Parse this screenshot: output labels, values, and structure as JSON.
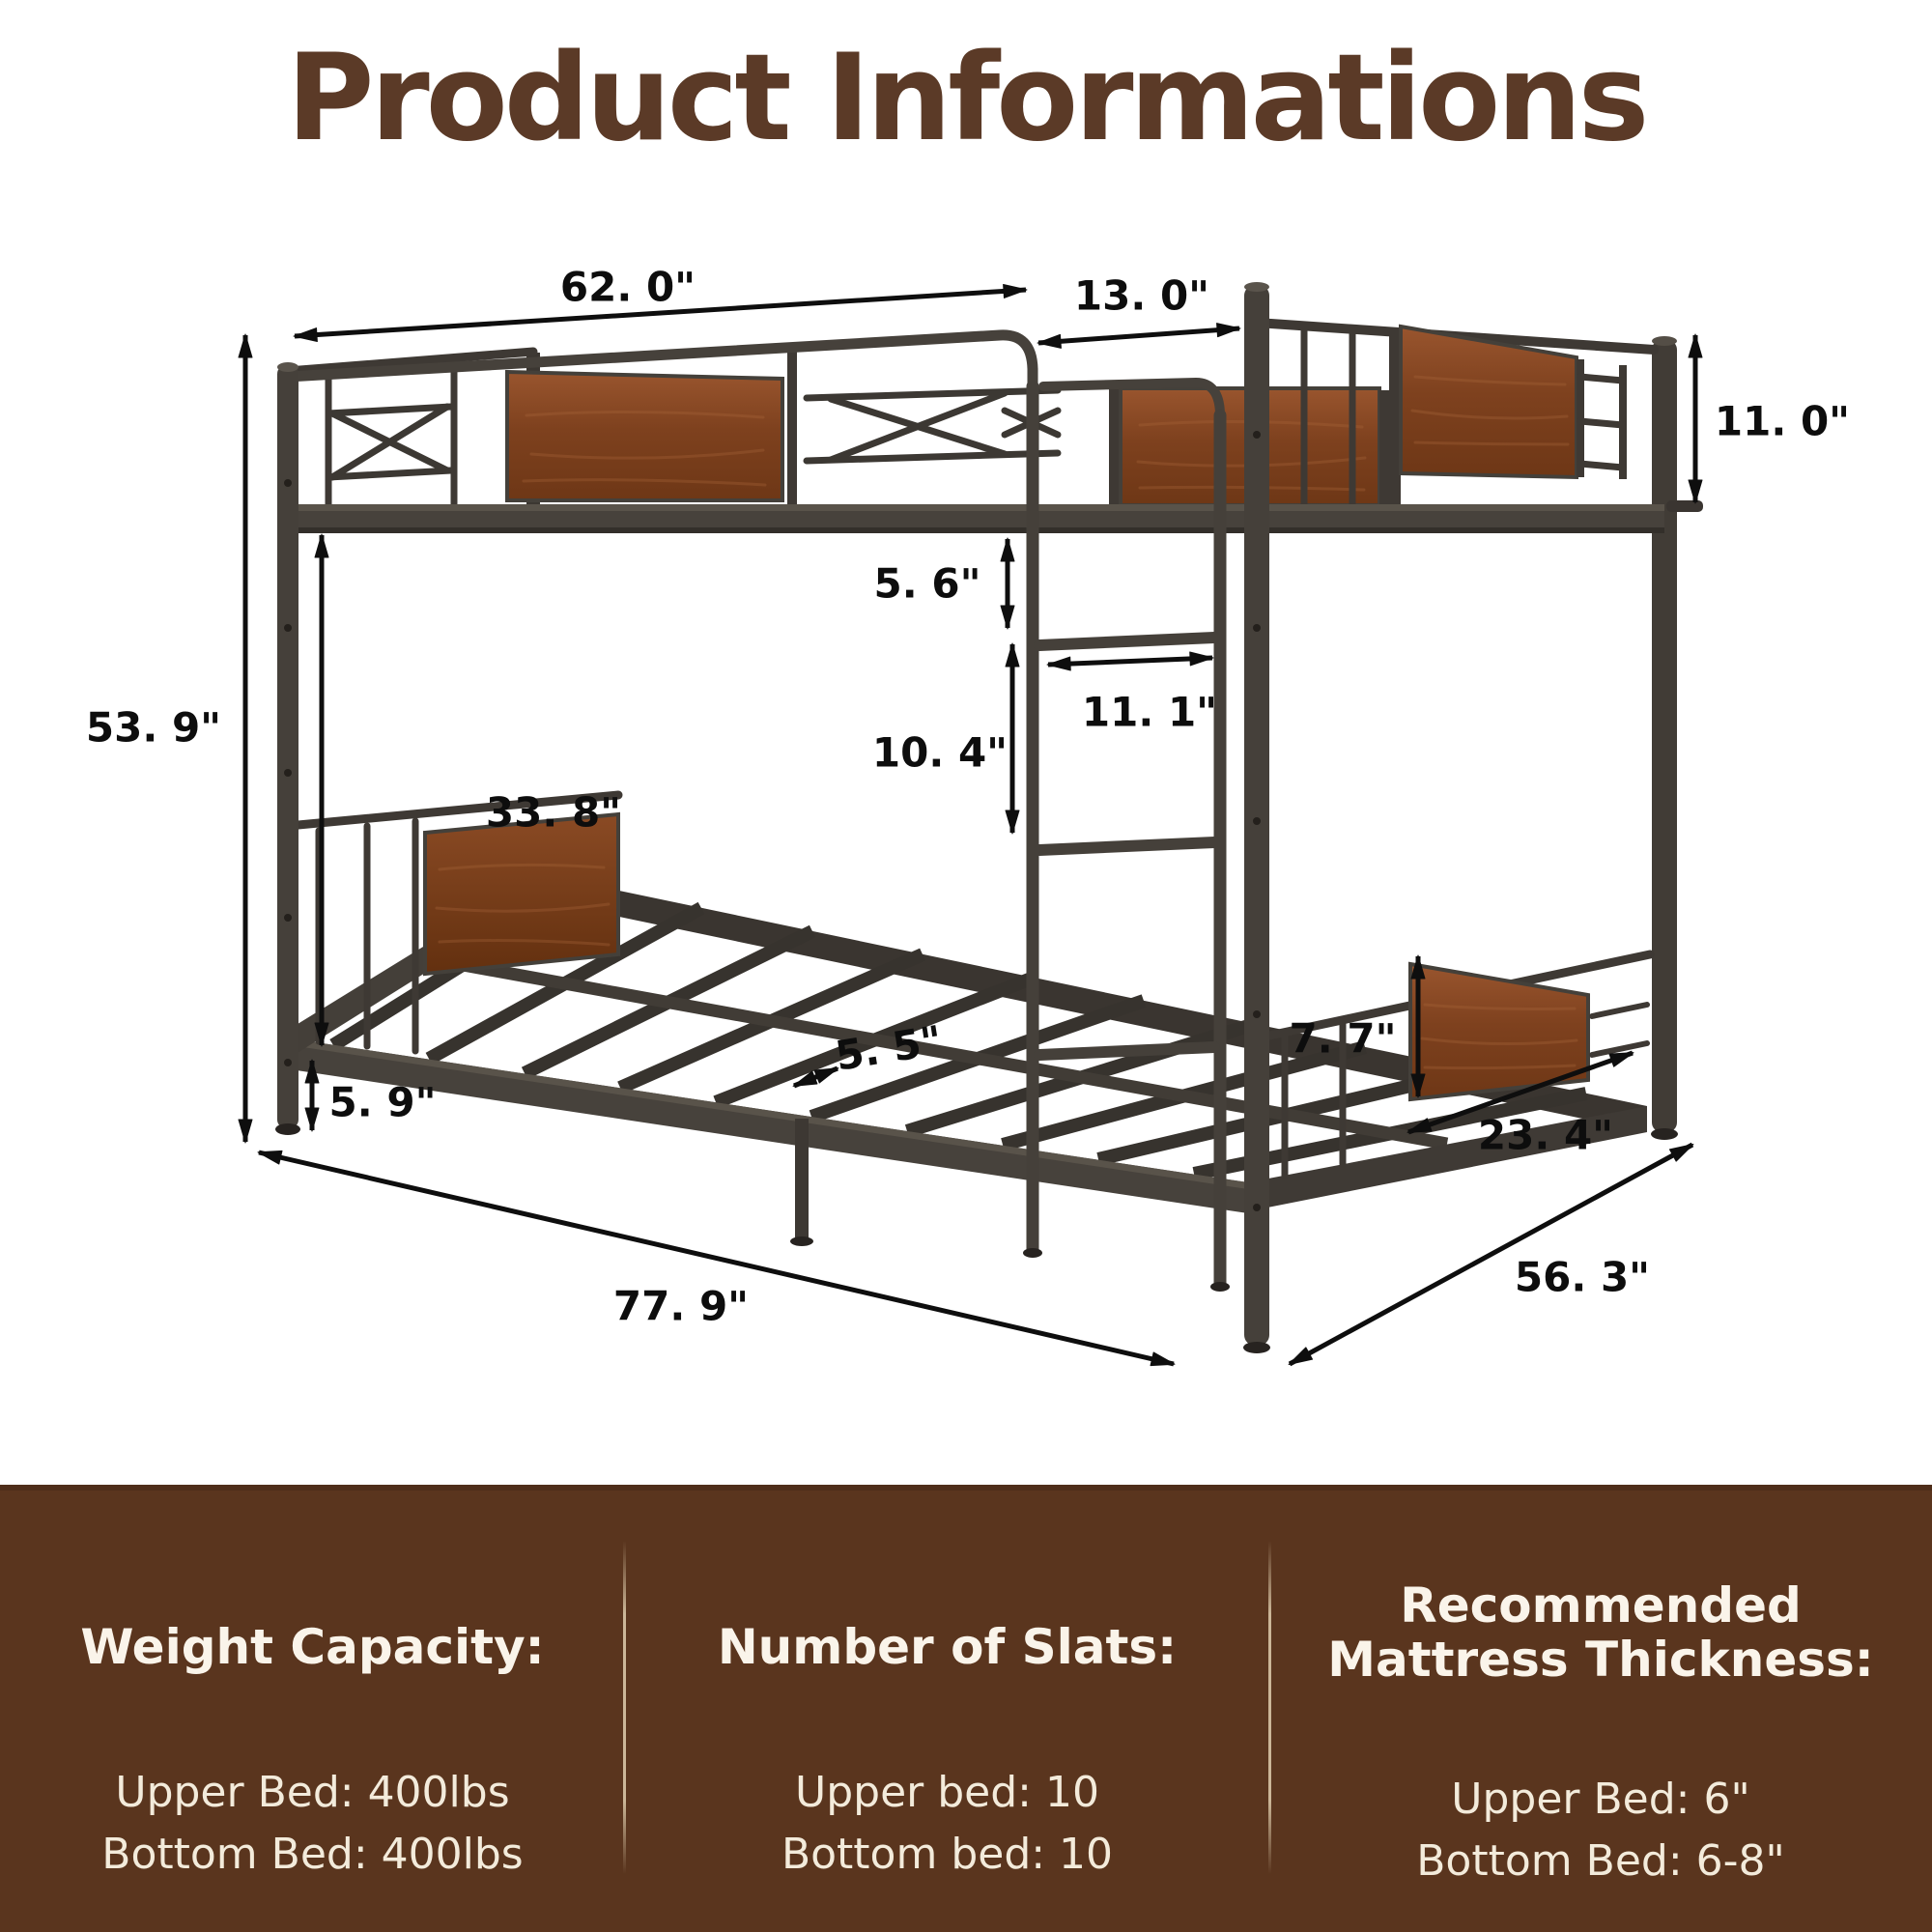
{
  "title": "Product Informations",
  "diagram": {
    "dims": {
      "top_width": "62. 0\"",
      "ladder_offset": "13. 0\"",
      "rail_height": "11. 0\"",
      "total_height": "53. 9\"",
      "bunk_clearance": "33. 8\"",
      "step_top_gap": "5. 6\"",
      "ladder_width": "11. 1\"",
      "rung_spacing": "10. 4\"",
      "slat_gap": "5. 5\"",
      "ground_clearance": "5. 9\"",
      "footboard_panel_height": "7. 7\"",
      "footboard_panel_width": "23. 4\"",
      "total_length": "77. 9\"",
      "total_depth": "56. 3\""
    }
  },
  "info_panel": {
    "columns": [
      {
        "heading_lines": [
          "Weight Capacity:"
        ],
        "items": [
          "Upper Bed: 400lbs",
          "Bottom Bed: 400lbs"
        ]
      },
      {
        "heading_lines": [
          "Number of Slats:"
        ],
        "items": [
          "Upper bed: 10",
          "Bottom bed: 10"
        ]
      },
      {
        "heading_lines": [
          "Recommended",
          "Mattress Thickness:"
        ],
        "items": [
          "Upper Bed: 6\"",
          "Bottom Bed: 6-8\""
        ]
      }
    ]
  },
  "colors": {
    "title_brown": "#5b3a27",
    "panel_brown": "#5a351e",
    "panel_text": "#f6efe3",
    "wood": "#8a4a22",
    "metal": "#46413b",
    "arrow_black": "#0e0e0e",
    "divider_tan": "#dfcdad"
  }
}
